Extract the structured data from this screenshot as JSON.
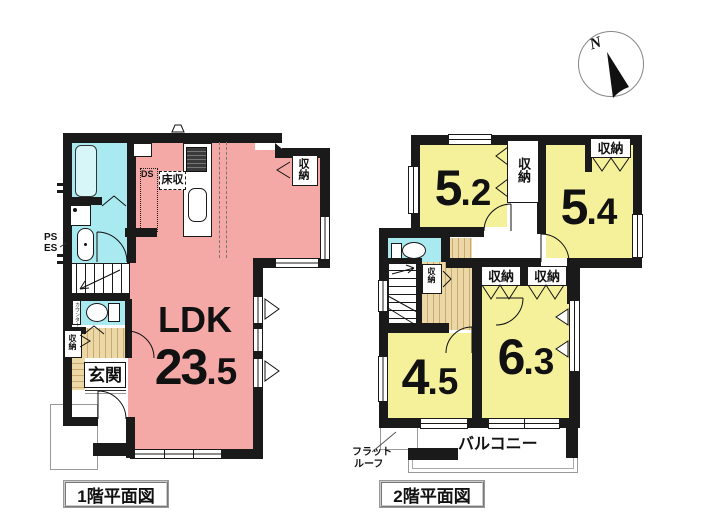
{
  "compass": {
    "north": "N"
  },
  "floor1": {
    "title": "1階平面図",
    "ldk": {
      "name": "LDK",
      "area_int": "23",
      "area_dec": ".5"
    },
    "genkan": "玄関",
    "closet_ne": "収納",
    "closet_hall": "収納",
    "floor_storage": "床収",
    "duct": "DS",
    "pipe_space": "PS",
    "electric_space": "ES",
    "counter": "カウンター"
  },
  "floor2": {
    "title": "2階平面図",
    "rooms": {
      "r52": {
        "int": "5",
        "dec": ".2"
      },
      "r54": {
        "int": "5",
        "dec": ".4"
      },
      "r45": {
        "int": "4",
        "dec": ".5"
      },
      "r63": {
        "int": "6",
        "dec": ".3"
      }
    },
    "closet_mid": "収納",
    "closet_ne": "収納",
    "closet_stairs": "収納",
    "closet_a": "収納",
    "closet_b": "収納",
    "balcony": "バルコニー",
    "flat_roof_1": "フラット",
    "flat_roof_2": "ルーフ"
  },
  "colors": {
    "wall": "#1a1a1a",
    "ldk_pink": "#f5a9a7",
    "room_yellow": "#f5f09a",
    "wet_cyan": "#a9e9f0",
    "wood": "#ecd8a6"
  }
}
